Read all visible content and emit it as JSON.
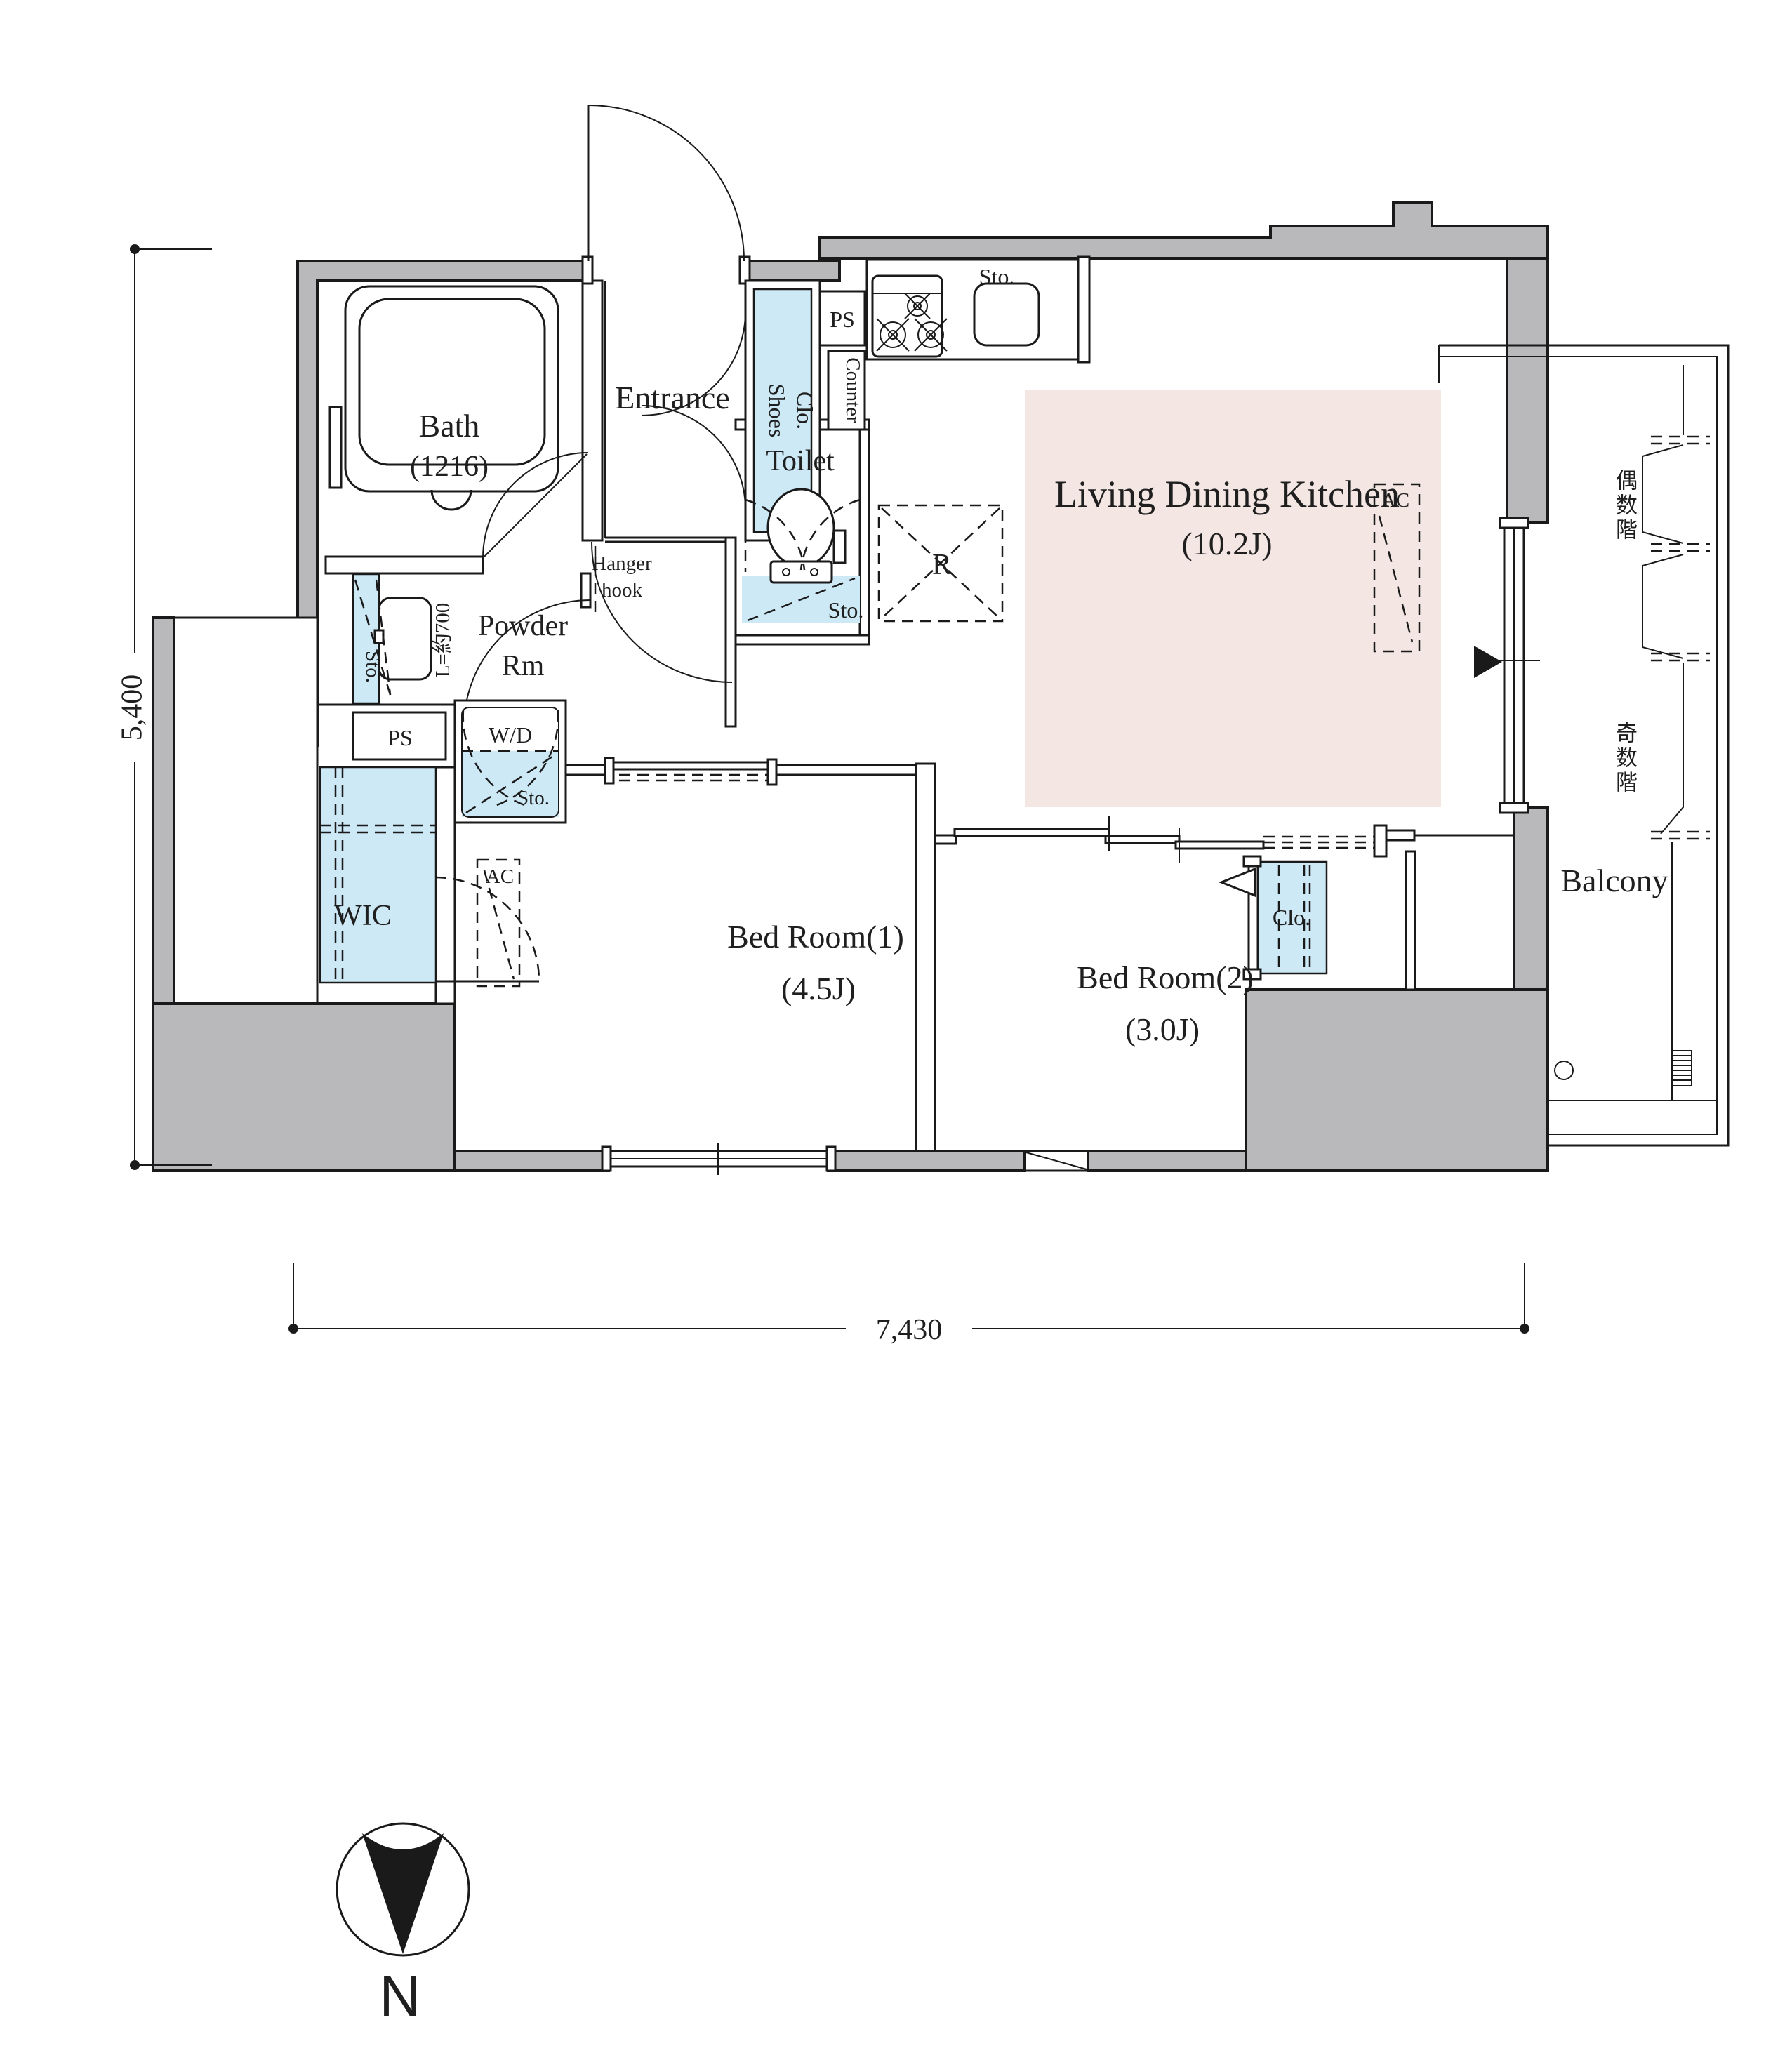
{
  "plan": {
    "rooms": {
      "bath": {
        "name": "Bath",
        "size": "(1216)"
      },
      "entrance": {
        "name": "Entrance"
      },
      "shoes_closet": {
        "line1": "Shoes",
        "line2": "Clo."
      },
      "toilet": {
        "name": "Toilet"
      },
      "powder_room": {
        "line1": "Powder",
        "line2": "Rm"
      },
      "ldk": {
        "name": "Living Dining Kitchen",
        "size": "(10.2J)"
      },
      "bedroom1": {
        "name": "Bed Room(1)",
        "size": "(4.5J)"
      },
      "bedroom2": {
        "name": "Bed Room(2)",
        "size": "(3.0J)"
      },
      "wic": {
        "name": "WIC"
      },
      "balcony": {
        "name": "Balcony"
      }
    },
    "fixtures": {
      "ps_upper": "PS",
      "ps_lower": "PS",
      "counter": "Counter",
      "hanger_line1": "Hanger",
      "hanger_line2": "hook",
      "refrigerator": "R",
      "washer_dryer": "W/D",
      "closet_bedroom2": "Clo.",
      "storage_kitchen": "Sto.",
      "storage_toilet": "Sto.",
      "storage_powder": "Sto.",
      "storage_wd": "Sto.",
      "ac_bedroom": "AC",
      "ac_ldk": "AC",
      "laundry_pole": "L=約700"
    },
    "balcony_notes": {
      "even_floors": "偶数階",
      "odd_floors": "奇数階"
    },
    "dimensions": {
      "width": "7,430",
      "height": "5,400"
    },
    "compass": {
      "north": "N"
    },
    "colors": {
      "wall_gray": "#b9b9bb",
      "ldk_floor_pink": "#f3e6e3",
      "storage_blue": "#cde9f6",
      "line_black": "#1a1a1a"
    }
  }
}
